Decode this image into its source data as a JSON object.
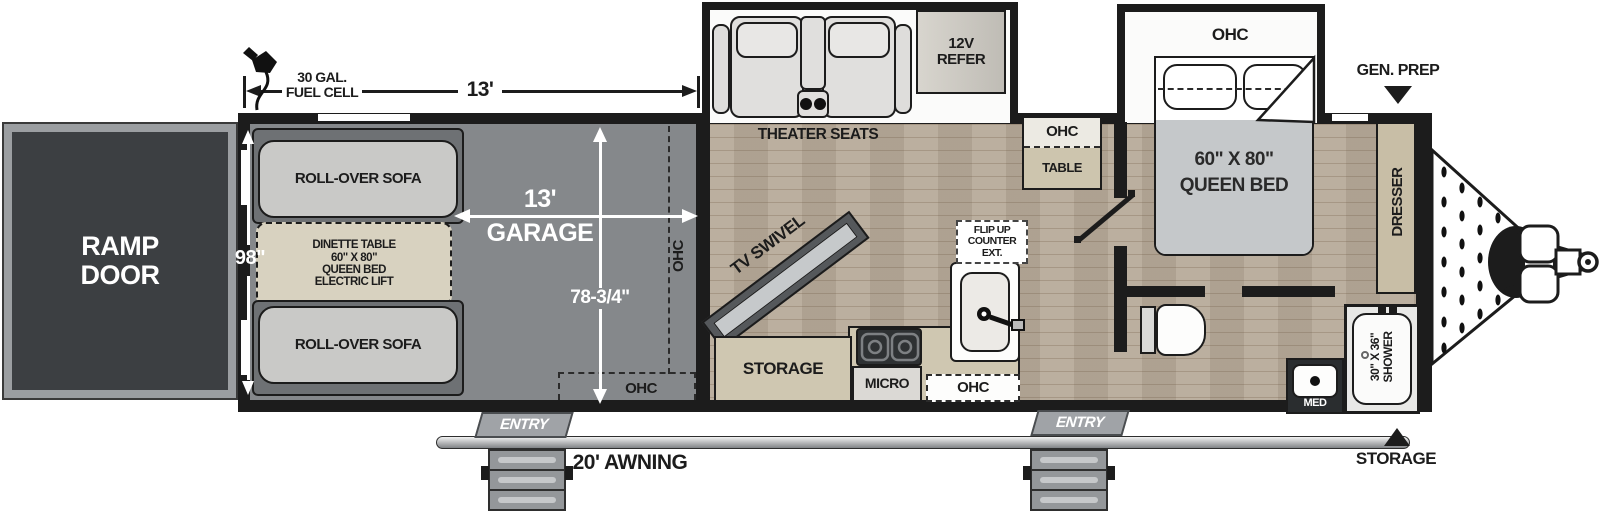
{
  "title": "Toy hauler travel trailer floor plan",
  "colors": {
    "wall": "#1c1c1c",
    "garage_floor": "#85888b",
    "wood_floor": "#b7aa99",
    "tan": "#cfc7b1",
    "ramp": "#3c3f42"
  },
  "dims": {
    "fuel_line1": "30 GAL.",
    "fuel_line2": "FUEL CELL",
    "length": "13'",
    "width": "98\"",
    "garage_line1": "13'",
    "garage_line2": "GARAGE",
    "garage_depth": "78-3/4\"",
    "awning": "20' AWNING"
  },
  "exterior": {
    "ramp_line1": "RAMP",
    "ramp_line2": "DOOR",
    "gen_prep": "GEN. PREP",
    "front_storage": "STORAGE",
    "entry_left": "ENTRY",
    "entry_right": "ENTRY"
  },
  "garage": {
    "sofa_top": "ROLL-OVER SOFA",
    "sofa_bottom": "ROLL-OVER SOFA",
    "dinette_lines": [
      "DINETTE TABLE",
      "60\" X 80\"",
      "QUEEN BED",
      "ELECTRIC LIFT"
    ],
    "ohc_side": "OHC",
    "ohc_rear": "OHC"
  },
  "living": {
    "theater_seats": "THEATER SEATS",
    "refer_line1": "12V",
    "refer_line2": "REFER",
    "tv_swivel": "TV SWIVEL",
    "storage": "STORAGE",
    "micro": "MICRO",
    "ohc_kitchen": "OHC",
    "flip_lines": [
      "FLIP UP",
      "COUNTER",
      "EXT."
    ],
    "ohc_dinette": "OHC",
    "table": "TABLE"
  },
  "bedroom": {
    "ohc": "OHC",
    "bed_line1": "60\" X 80\"",
    "bed_line2": "QUEEN BED",
    "dresser": "DRESSER"
  },
  "bath": {
    "med": "MED",
    "shower_line1": "30\" X 36\"",
    "shower_line2": "SHOWER"
  }
}
